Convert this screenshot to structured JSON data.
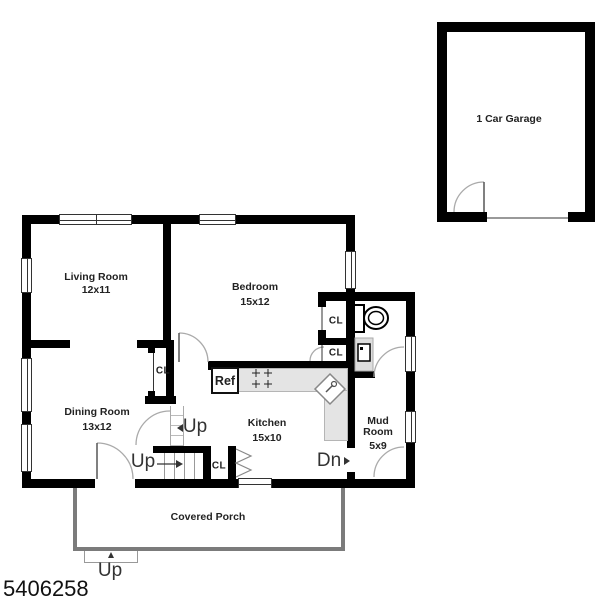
{
  "plan_number": "5406258",
  "rooms": {
    "living": {
      "name": "Living Room",
      "dims": "12x11"
    },
    "bedroom": {
      "name": "Bedroom",
      "dims": "15x12"
    },
    "dining": {
      "name": "Dining Room",
      "dims": "13x12"
    },
    "kitchen": {
      "name": "Kitchen",
      "dims": "15x10"
    },
    "mudroom": {
      "line1": "Mud",
      "line2": "Room",
      "dims": "5x9"
    },
    "garage": {
      "name": "1 Car Garage"
    },
    "porch": {
      "name": "Covered Porch"
    }
  },
  "labels": {
    "closet": "CL",
    "refrigerator": "Ref",
    "up": "Up",
    "down": "Dn"
  },
  "colors": {
    "wall": "#000000",
    "counter": "#e4e4e4",
    "porch_border": "#7b7b7b",
    "door_arc": "#aaaaaa"
  }
}
